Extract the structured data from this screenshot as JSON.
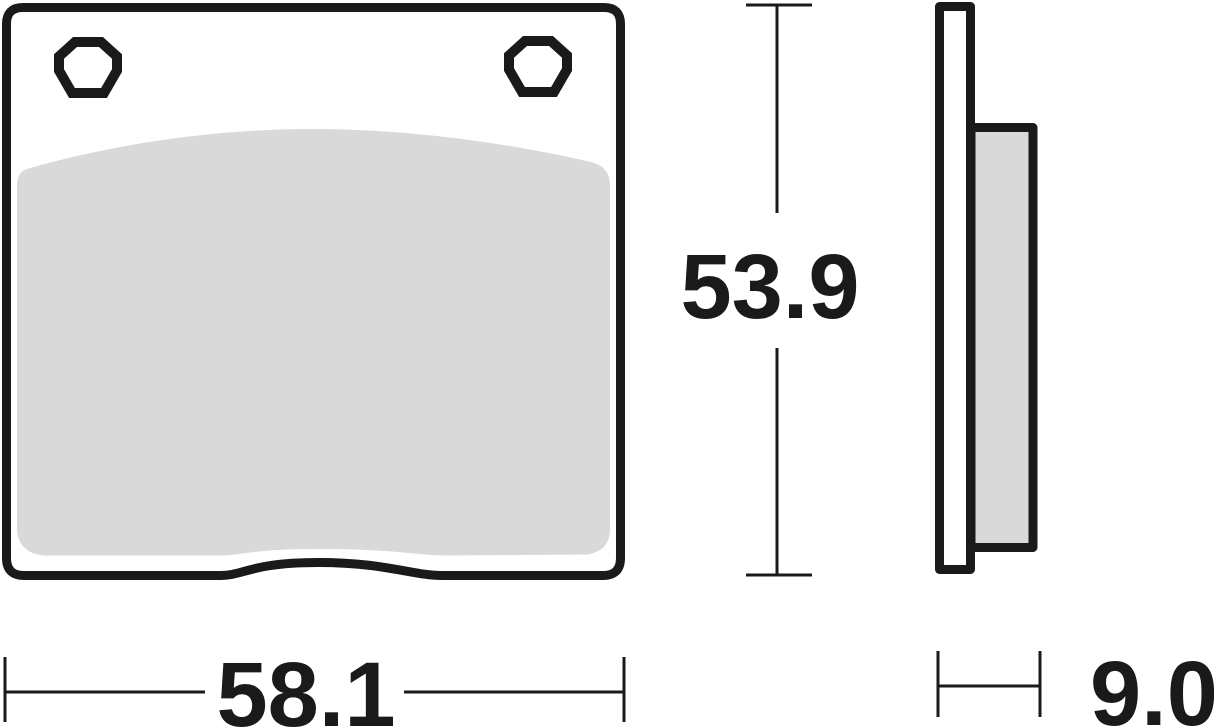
{
  "drawing": {
    "dimensions": {
      "width": {
        "value": "58.1"
      },
      "height": {
        "value": "53.9"
      },
      "thickness": {
        "value": "9.0"
      }
    },
    "colors": {
      "line": "#1a1a1a",
      "friction_material": "#d9d9d9",
      "backing_plate": "#ffffff",
      "background": "#ffffff"
    }
  }
}
